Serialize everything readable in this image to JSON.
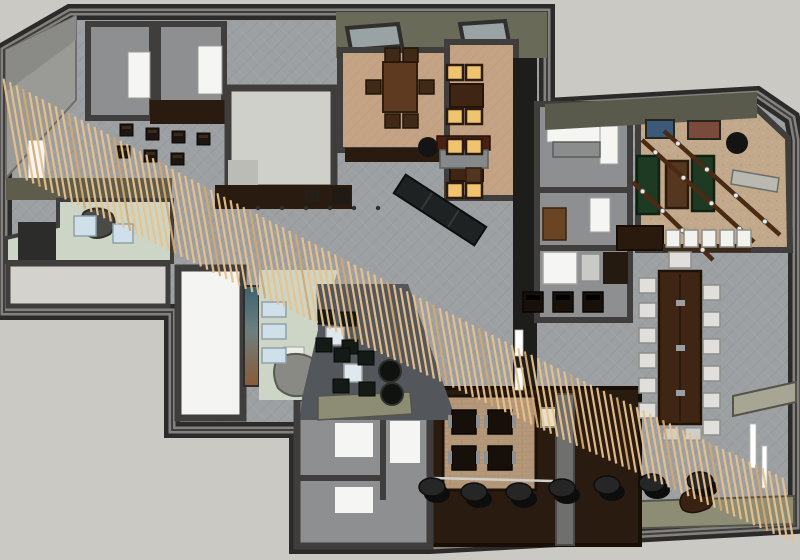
{
  "meta": {
    "title": "3D floor plan rendering",
    "alt": "Top-down 3D rendering of an interior floor plan with dining rooms, lounge, game room, conference table and a diagonal wood-slat ceiling feature"
  },
  "palette": {
    "bg": "#cac9c3",
    "wallDark": "#3f3e3c",
    "wallEdge": "#2c2b29",
    "wallHighlight": "#83827e",
    "carpet": "#9da0a2",
    "carpetLine": "#8f9295",
    "roomGray": "#d0d0ca",
    "floorGray": "#8e8f90",
    "tan": "#c4a384",
    "tanGame": "#c3a98b",
    "brick": "#b59879",
    "woodDark": "#2a1b10",
    "woodMid": "#5e3b20",
    "woodTable": "#3f2614",
    "slat": "#e9c28c",
    "slatDark": "#d6a96e",
    "tableGreen": "#1e3a22",
    "paleGreen": "#cdd6c6",
    "paleRoom": "#d3d2cc",
    "lounge": "#53565a",
    "amber": "#f0c46e",
    "olive": "#8d8c75",
    "oliveDark": "#5e5d4c",
    "ceiling": "#6a6a58",
    "white": "#f5f5f3",
    "blue": "#cfe0ea",
    "black": "#141414",
    "chair": "#e0dfdb",
    "muralTop": "#3b6272",
    "muralBottom": "#8a5a38"
  },
  "scene": {
    "rooms": [
      {
        "name": "private-dining-left"
      },
      {
        "name": "private-dining-right"
      },
      {
        "name": "stair-room"
      },
      {
        "name": "entry"
      },
      {
        "name": "gallery-lounge"
      },
      {
        "name": "game-room"
      },
      {
        "name": "conference-area"
      },
      {
        "name": "booth-dining"
      },
      {
        "name": "stage"
      },
      {
        "name": "restrooms"
      },
      {
        "name": "offices"
      },
      {
        "name": "bar"
      }
    ],
    "slats": {
      "count": 120,
      "len_start": 100,
      "len_end": 66,
      "dir": [
        0.17,
        0.985
      ],
      "band": [
        [
          12,
          128
        ],
        [
          120,
          183
        ],
        [
          235,
          243
        ],
        [
          345,
          298
        ],
        [
          455,
          352
        ],
        [
          565,
          406
        ],
        [
          675,
          458
        ],
        [
          788,
          510
        ]
      ]
    },
    "poufs": {
      "x": [
        432,
        474,
        519,
        562,
        607,
        652,
        700
      ],
      "y": [
        487,
        492,
        492,
        488,
        485,
        483,
        481
      ]
    },
    "bar_stools": {
      "x": [
        666,
        684,
        702,
        720,
        737
      ],
      "y": 230
    },
    "conference": {
      "left_ys": [
        278,
        303,
        328,
        353,
        378,
        403
      ],
      "right_ys": [
        285,
        312,
        339,
        366,
        393,
        420
      ],
      "left_x": 639,
      "right_x": 703,
      "head_chair": [
        669,
        252,
        22,
        16
      ],
      "foot_pads": [
        [
          663,
          428
        ],
        [
          685,
          428
        ]
      ]
    },
    "booths": [
      [
        452,
        410
      ],
      [
        488,
        410
      ],
      [
        452,
        446
      ],
      [
        488,
        446
      ]
    ],
    "amber_seats": [
      [
        447,
        65
      ],
      [
        466,
        65
      ],
      [
        447,
        109
      ],
      [
        466,
        109
      ],
      [
        447,
        139
      ],
      [
        466,
        139
      ],
      [
        447,
        183
      ],
      [
        466,
        183
      ]
    ],
    "dining_left_chairs": [
      [
        385,
        48
      ],
      [
        403,
        48
      ],
      [
        385,
        114
      ],
      [
        403,
        114
      ],
      [
        366,
        80
      ],
      [
        419,
        80
      ]
    ],
    "corridor_stools": [
      [
        120,
        124
      ],
      [
        146,
        128
      ],
      [
        172,
        131
      ],
      [
        117,
        146
      ],
      [
        144,
        150
      ],
      [
        171,
        153
      ],
      [
        197,
        133
      ]
    ],
    "office_stools": [
      [
        523,
        292
      ],
      [
        553,
        292
      ],
      [
        583,
        292
      ]
    ],
    "lounge": {
      "tables": [
        [
          326,
          327
        ],
        [
          344,
          364
        ]
      ],
      "chairs": [
        [
          318,
          310
        ],
        [
          340,
          312
        ],
        [
          316,
          338
        ],
        [
          342,
          340
        ],
        [
          334,
          348
        ],
        [
          358,
          351
        ],
        [
          333,
          379
        ],
        [
          359,
          382
        ]
      ],
      "poufs": [
        [
          390,
          371
        ],
        [
          392,
          394
        ]
      ]
    },
    "green_tables": [
      [
        637,
        156,
        22,
        58
      ],
      [
        692,
        156,
        22,
        55
      ]
    ],
    "brown_game_table": [
      666,
      161,
      22,
      47
    ],
    "beams": [
      [
        642,
        140,
        754,
        242
      ],
      [
        664,
        131,
        780,
        235
      ],
      [
        633,
        182,
        713,
        260
      ]
    ],
    "picture_frames": [
      [
        646,
        120,
        28,
        18
      ],
      [
        688,
        121,
        32,
        18
      ]
    ],
    "entry_mats": [
      [
        74,
        216,
        22,
        20
      ],
      [
        113,
        224,
        20,
        19
      ]
    ],
    "wing_benches": [
      [
        262,
        302,
        24,
        15
      ],
      [
        262,
        324,
        24,
        15
      ],
      [
        262,
        348,
        24,
        15
      ]
    ],
    "ceiling_dots": {
      "xs": [
        258,
        282,
        306,
        330,
        354,
        378
      ],
      "y": 208
    },
    "wall_lights_left": [
      [
        515,
        330,
        8,
        26
      ],
      [
        515,
        368,
        8,
        22
      ]
    ],
    "wall_lights_right": [
      [
        750,
        424,
        6,
        44
      ],
      [
        762,
        446,
        5,
        42
      ]
    ],
    "skylights": [
      "347,28 398,24 402,46 351,50",
      "460,24 505,21 509,42 464,45"
    ]
  }
}
